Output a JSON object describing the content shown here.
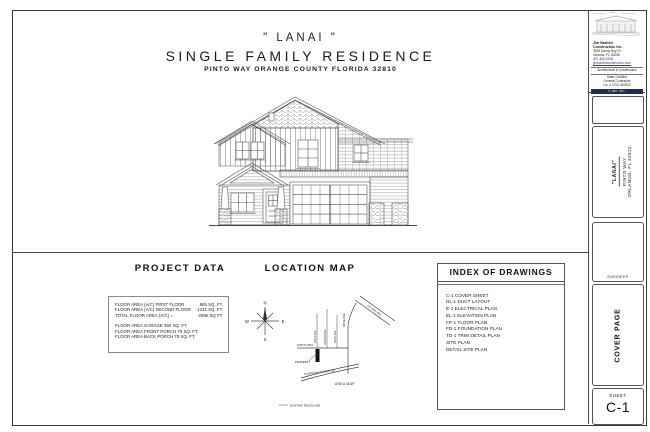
{
  "title_block": {
    "project_name": "\" LANAI \"",
    "subtitle": "SINGLE  FAMILY  RESIDENCE",
    "address": "PINTO WAY   ORANGE COUNTY FLORIDA   32810"
  },
  "project_data": {
    "heading": "PROJECT  DATA",
    "area_rows": [
      {
        "label": "FLOOR AREA (A/C) FIRST FLOOR",
        "value": "865 SQ. FT."
      },
      {
        "label": "FLOOR AREA (A/C) SECOND FLOOR",
        "value": "1231 SQ. FT."
      },
      {
        "label": "TOTAL FLOOR AREA (A/C) =",
        "value": "2096 SQ FT."
      }
    ],
    "other_rows": [
      "FLOOR AREA GARAGE 394 SQ. FT.",
      "FLOOR AREA FRONT PORCH 79 SQ. FT.",
      "FLOOR AREA BACK PORCH 78 SQ. FT."
    ]
  },
  "location_map": {
    "heading": "LOCATION  MAP",
    "compass": {
      "n": "N",
      "e": "E",
      "s": "S",
      "w": "W"
    },
    "labels": {
      "pinto_way": "PINTO WAY",
      "property": "PROPERTY",
      "clarcona": "CLARCONA OCOEE RD",
      "area_map": "AREA MAP",
      "fence": "EXISTING FENCE LINE",
      "rose_ave": "ROSE AVE",
      "street1": "GOLD AVE",
      "street2": "JORDAN AVE",
      "street3": "ROCK AVE",
      "highway": "US HWY 441"
    }
  },
  "index_of_drawings": {
    "heading": "INDEX OF DRAWINGS",
    "items": [
      "C-1 COVER SHEET",
      "DL-1 DUCT LAYOUT",
      "E-1 ELECTRICAL PLAN",
      "EL-1 ELEVATION PLAN",
      "FP-1 FLOOR PLAN",
      "FD-1 FOUNDATION PLAN",
      "TD-1 TRIM DETAIL PLAN",
      "SITE PLAN",
      "DETAIL SITE PLAN"
    ]
  },
  "sidebar": {
    "company": {
      "name": "Jim Bartlett",
      "name2": "Construction Inc.",
      "address1": "3939 Danny Boy Dr.",
      "address2": "Orlando, FL  32808",
      "phone": "407-402-6708",
      "web": "jimbartlettconstruction.com",
      "tagline": "Architectural & Construction",
      "cert1": "State Certified",
      "cert2": "General Contractor",
      "cert3": "Lic. # CGC 040503",
      "bar_text": "© JBC INC."
    },
    "project": {
      "name": "\"LANAI\"",
      "street": "PINTO WAY",
      "city": "ORLANDO, FL  32810"
    },
    "engineer_label": "ENGINEER",
    "cover_label": "COVER PAGE",
    "sheet_label": "SHEET",
    "sheet_number": "C-1"
  }
}
